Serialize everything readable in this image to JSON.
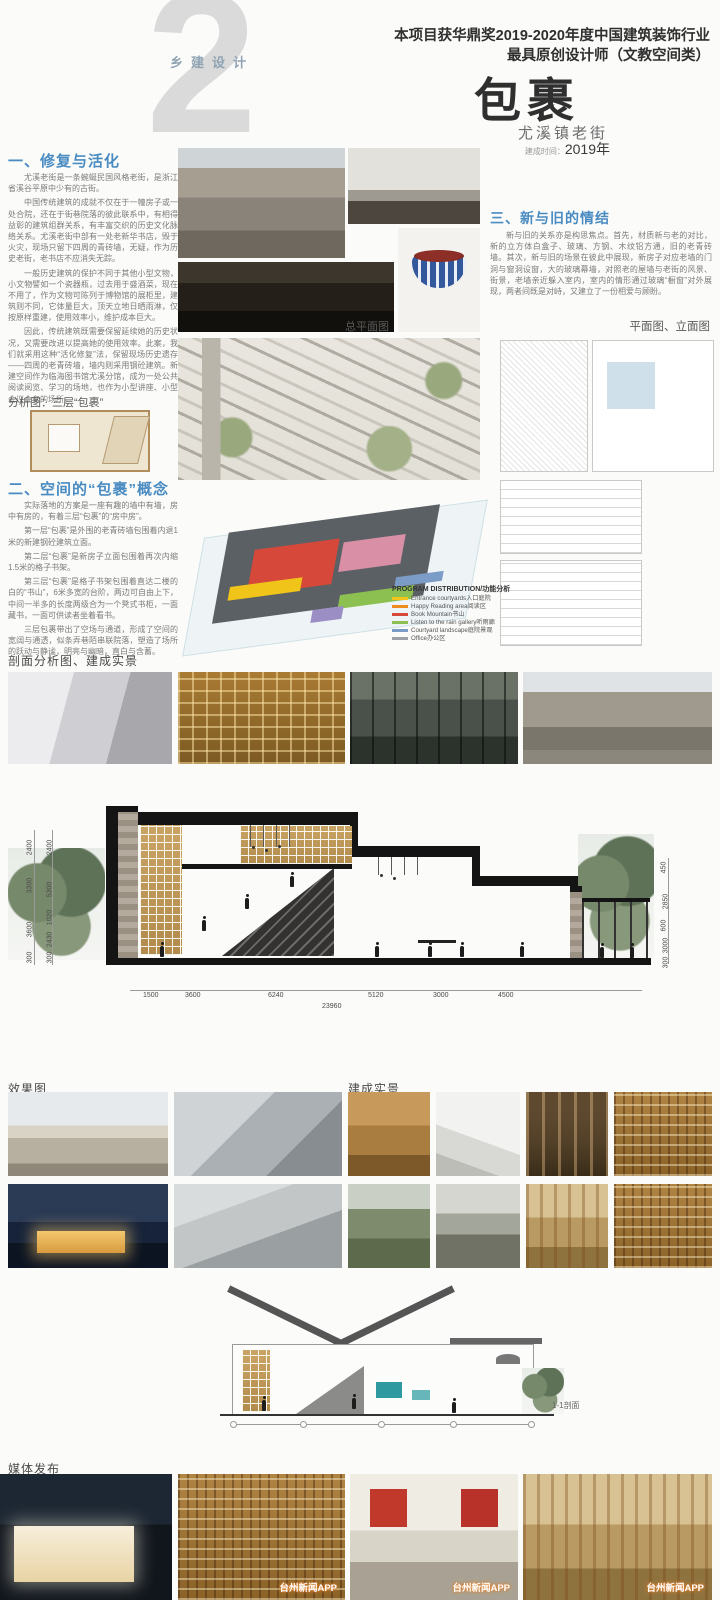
{
  "header": {
    "series_label": "乡建设计",
    "big_number": "2",
    "award_line1": "本项目获华鼎奖2019-2020年度中国建筑装饰行业",
    "award_line2": "最具原创设计师（文教空间类）",
    "title": "包裹",
    "subtitle": "尤溪镇老街",
    "built_label": "建成时间：",
    "built_value": "2019年"
  },
  "section1": {
    "heading": "一、修复与活化",
    "paragraphs": [
      "尤溪老街是一条蜿蜒民国风格老街，是浙江省溪谷平原中少有的古街。",
      "中国传统建筑的成就不仅在于一幢房子或一处合院，还在于街巷院落的彼此联系中，有相得益彰的建筑组群关系，有丰富交织的历史文化脉络关系。尤溪老街中部有一处老新华书店，毁于火灾，现场只留下四周的青砖墙，无疑，作为历史老街，老书店不应消失无踪。",
      "一般历史建筑的保护不同于其他小型文物，小文物譬如一个瓷器瓶，过去用于盛酒菜，现在不用了，作为文物可陈列于博物馆的展柜里，建筑则不同，它体量巨大，顶天立地日晒雨淋，仅按原样重建，使用效率小，维护成本巨大。",
      "因此，传统建筑既需要保留延续她的历史状况，又需要改进以提高她的使用效率。此案，我们就采用这种“活化修复”法，保留现场历史遗存——四周的老青砖墙，墙内则采用钢砼建筑。新建空间作为临海图书馆尤溪分馆，成为一处公共阅读阅览、学习的场地，也作为小型讲座、小型会议会务的场所。"
    ]
  },
  "analysis": {
    "caption": "分析图：三层“包裹”"
  },
  "section2": {
    "heading": "二、空间的“包裹”概念",
    "paragraphs": [
      "实际落地的方案是一座有趣的墙中有墙，房中有房的，有着三层“包裹”的“房中房”。",
      "第一层“包裹”是外围的老青砖墙包围着内退1米的新建钢砼建筑立面。",
      "第二层“包裹”是新房子立面包围着再次内缩1.5米的格子书架。",
      "第三层“包裹”是格子书架包围着直达二楼的白的“书山”，6米多宽的台阶，两边可自由上下，中间一半多的长度两级合为一个凳式书柜，一面藏书，一面可供读者坐着看书。",
      "三层包裹带出了空场与通道，形成了空间的宽阔与通透，似条弄巷陌串联院落，塑造了场所的跃动与静谧，明亮与幽暗，直白与含蓄。"
    ]
  },
  "section3": {
    "heading": "三、新与旧的情结",
    "paragraphs": [
      "新与旧的关系亦是构思焦点。首先，材质新与老的对比，新的立方体白盒子、玻璃、方钢、木纹铝方通，旧的老青砖墙。其次，新与旧的场景在彼此中展现，新房子对应老墙的门洞与窗洞设窗，大的玻璃幕墙，对照老的屋墙与老街的风景、街景，老墙亲近躲入室内，室内的情形通过玻璃“橱窗”对外展现，两者间既是对峙，又建立了一份相爱与顾盼。"
    ]
  },
  "captions": {
    "site_plan": "总平面图",
    "plans_elevations": "平面图、立面图",
    "section_photos": "剖面分析图、建成实景",
    "renders": "效果图",
    "built": "建成实景",
    "media": "媒体发布",
    "small_section": "1-1剖面"
  },
  "legend": {
    "title": "PROGRAM DISTRIBUTION/功能分析",
    "items": [
      {
        "label": "Entrance courtyards入口庭院",
        "color": "#f0c419"
      },
      {
        "label": "Happy Reading area阅读区",
        "color": "#ef8c1e"
      },
      {
        "label": "Book Mountain书山",
        "color": "#d6483a"
      },
      {
        "label": "Listen to the rain gallery听雨廊",
        "color": "#8cc051"
      },
      {
        "label": "Courtyard landscape庭院景观",
        "color": "#7a9cc6"
      },
      {
        "label": "Office办公区",
        "color": "#9aa0a6"
      }
    ]
  },
  "dims": {
    "bottom": [
      "1500",
      "3600",
      "6240",
      "5120",
      "3000",
      "4500"
    ],
    "total": "23960",
    "left_outer": [
      "2400",
      "3300",
      "3600",
      "300"
    ],
    "left_inner": [
      "2400",
      "5300",
      "1020",
      "2430",
      "300"
    ],
    "right": [
      "450",
      "2850",
      "600",
      "3000",
      "300"
    ]
  },
  "watermark": "台州新闻APP",
  "colors": {
    "accent_heading": "#4a8cc2",
    "big_number": "#dadada",
    "title_text": "#2f2f2f"
  }
}
